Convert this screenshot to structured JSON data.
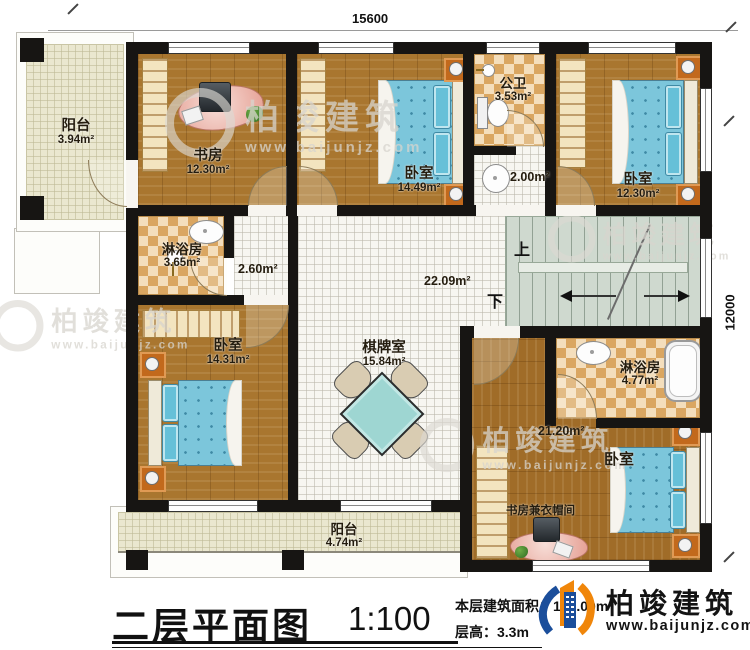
{
  "title_block": {
    "plan_title": "二层平面图",
    "scale": "1:100",
    "floor_area": "本层建筑面积：163.00m²",
    "floor_height": "层高：3.3m"
  },
  "logo": {
    "company": "柏竣建筑",
    "website": "www.baijunjz.com"
  },
  "watermark": {
    "company": "柏竣建筑",
    "website": "www.baijunjz.com"
  },
  "dimensions": {
    "width_mm": "15600",
    "depth_mm": "12000"
  },
  "stairs": {
    "up_label": "上",
    "down_label": "下"
  },
  "rooms": {
    "balcony_top": {
      "name": "阳台",
      "area": "3.94m²"
    },
    "study": {
      "name": "书房",
      "area": "12.30m²"
    },
    "bedroom_top_mid": {
      "name": "卧室",
      "area": "14.49m²"
    },
    "public_bath": {
      "name": "公卫",
      "area": "3.53m²"
    },
    "wash_area": {
      "area": "2.00m²"
    },
    "bedroom_top_right": {
      "name": "卧室",
      "area": "12.30m²"
    },
    "shower_left": {
      "name": "淋浴房",
      "area": "3.65m²"
    },
    "corridor": {
      "area": "2.60m²"
    },
    "hall": {
      "area": "22.09m²"
    },
    "bedroom_left": {
      "name": "卧室",
      "area": "14.31m²"
    },
    "chess_room": {
      "name": "棋牌室",
      "area": "15.84m²"
    },
    "shower_right": {
      "name": "淋浴房",
      "area": "4.77m²"
    },
    "bedroom_bottom_right": {
      "name": "卧室",
      "area": "21.20m²",
      "sub_label": "书房兼衣帽间"
    },
    "balcony_bottom": {
      "name": "阳台",
      "area": "4.74m²"
    }
  },
  "colors": {
    "wall": "#171513",
    "wood_floor": "#a9762f",
    "tile_floor": "#f7f6f1",
    "checker_dark": "#daa661",
    "checker_light": "#f4debc",
    "balcony_floor": "#eae7cf",
    "stairs_floor": "#cfd9cf",
    "bed_blue": "#7cc6db",
    "logo_blue": "#1b4e9b",
    "logo_orange": "#f0860a"
  }
}
